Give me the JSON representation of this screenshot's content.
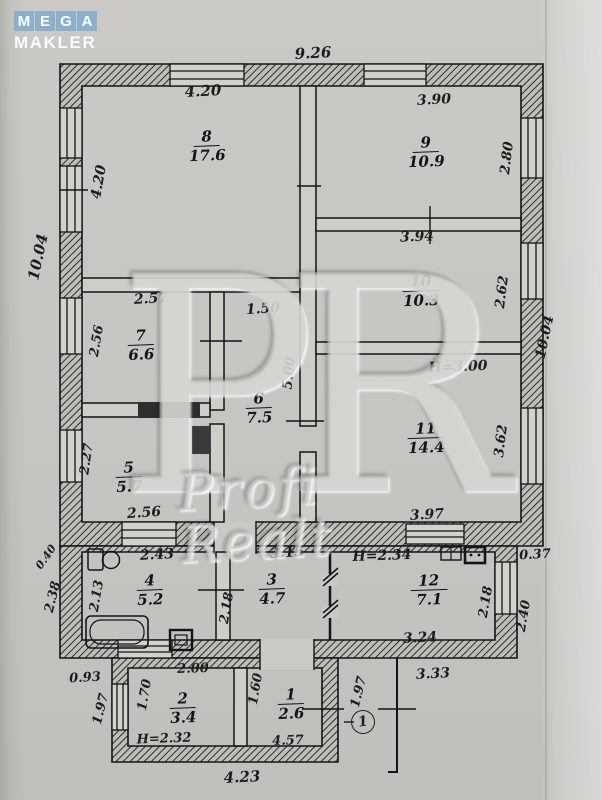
{
  "logo": {
    "letters": [
      "M",
      "E",
      "G",
      "A"
    ],
    "word": "MAKLER"
  },
  "watermark": {
    "monogram": "PR",
    "text": "Profi Realt"
  },
  "plan": {
    "porch_label": "1",
    "rooms": [
      {
        "number": "8",
        "area": "17.6",
        "x": 207,
        "y": 146
      },
      {
        "number": "9",
        "area": "10.9",
        "x": 426,
        "y": 152
      },
      {
        "number": "10",
        "area": "10.3",
        "x": 421,
        "y": 291
      },
      {
        "number": "11",
        "area": "14.4",
        "x": 426,
        "y": 438
      },
      {
        "number": "7",
        "area": "6.6",
        "x": 141,
        "y": 345
      },
      {
        "number": "6",
        "area": "7.5",
        "x": 259,
        "y": 408
      },
      {
        "number": "5",
        "area": "5.7",
        "x": 129,
        "y": 477
      },
      {
        "number": "4",
        "area": "5.2",
        "x": 150,
        "y": 590
      },
      {
        "number": "3",
        "area": "4.7",
        "x": 272,
        "y": 589
      },
      {
        "number": "12",
        "area": "7.1",
        "x": 429,
        "y": 590
      },
      {
        "number": "2",
        "area": "3.4",
        "x": 183,
        "y": 708
      },
      {
        "number": "1",
        "area": "2.6",
        "x": 291,
        "y": 704
      }
    ],
    "dims": [
      {
        "text": "9.26",
        "x": 313,
        "y": 53,
        "rot": -3,
        "size": 15
      },
      {
        "text": "4.20",
        "x": 203,
        "y": 91,
        "rot": -3,
        "size": 15
      },
      {
        "text": "4.20",
        "x": 99,
        "y": 182,
        "rot": -80,
        "size": 14
      },
      {
        "text": "10.04",
        "x": 38,
        "y": 257,
        "rot": -78,
        "size": 15
      },
      {
        "text": "3.90",
        "x": 434,
        "y": 100,
        "rot": -3,
        "size": 14
      },
      {
        "text": "2.80",
        "x": 507,
        "y": 158,
        "rot": -83,
        "size": 13.5
      },
      {
        "text": "3.94",
        "x": 417,
        "y": 237,
        "rot": -2,
        "size": 14
      },
      {
        "text": "2.62",
        "x": 502,
        "y": 292,
        "rot": -83,
        "size": 13.5
      },
      {
        "text": "10.04",
        "x": 545,
        "y": 337,
        "rot": -78,
        "size": 14
      },
      {
        "text": "H=3.00",
        "x": 458,
        "y": 367,
        "rot": -2,
        "size": 14
      },
      {
        "text": "3.62",
        "x": 501,
        "y": 441,
        "rot": -83,
        "size": 13.5
      },
      {
        "text": "3.97",
        "x": 427,
        "y": 515,
        "rot": -3,
        "size": 14
      },
      {
        "text": "2.57",
        "x": 151,
        "y": 299,
        "rot": -3,
        "size": 14
      },
      {
        "text": "2.56",
        "x": 97,
        "y": 341,
        "rot": -80,
        "size": 13
      },
      {
        "text": "1.50",
        "x": 263,
        "y": 309,
        "rot": -4,
        "size": 14
      },
      {
        "text": "5.00",
        "x": 289,
        "y": 373,
        "rot": -85,
        "size": 13.5
      },
      {
        "text": "2.27",
        "x": 87,
        "y": 459,
        "rot": -82,
        "size": 13
      },
      {
        "text": "2.56",
        "x": 144,
        "y": 513,
        "rot": -4,
        "size": 14
      },
      {
        "text": "0.40",
        "x": 46,
        "y": 557,
        "rot": -55,
        "size": 11
      },
      {
        "text": "2.38",
        "x": 53,
        "y": 597,
        "rot": -76,
        "size": 13
      },
      {
        "text": "2.43",
        "x": 157,
        "y": 555,
        "rot": -3,
        "size": 14
      },
      {
        "text": "2.13",
        "x": 97,
        "y": 596,
        "rot": -80,
        "size": 13
      },
      {
        "text": "3.15",
        "x": 287,
        "y": 553,
        "rot": -4,
        "size": 14
      },
      {
        "text": "2.18",
        "x": 227,
        "y": 608,
        "rot": -80,
        "size": 13
      },
      {
        "text": "H=2.34",
        "x": 382,
        "y": 556,
        "rot": -2,
        "size": 14
      },
      {
        "text": "2.18",
        "x": 486,
        "y": 602,
        "rot": -80,
        "size": 13
      },
      {
        "text": "0.37",
        "x": 535,
        "y": 555,
        "rot": -3,
        "size": 13
      },
      {
        "text": "2.40",
        "x": 524,
        "y": 616,
        "rot": -80,
        "size": 13
      },
      {
        "text": "3.24",
        "x": 420,
        "y": 638,
        "rot": -3,
        "size": 14
      },
      {
        "text": "3.33",
        "x": 433,
        "y": 674,
        "rot": -3,
        "size": 14
      },
      {
        "text": "0.93",
        "x": 85,
        "y": 678,
        "rot": -3,
        "size": 13
      },
      {
        "text": "2.00",
        "x": 193,
        "y": 669,
        "rot": -2,
        "size": 13
      },
      {
        "text": "1.70",
        "x": 145,
        "y": 695,
        "rot": -80,
        "size": 13
      },
      {
        "text": "1.60",
        "x": 256,
        "y": 689,
        "rot": -80,
        "size": 13
      },
      {
        "text": "1.97",
        "x": 101,
        "y": 709,
        "rot": -76,
        "size": 13
      },
      {
        "text": "1.97",
        "x": 359,
        "y": 692,
        "rot": -76,
        "size": 13
      },
      {
        "text": "H=2.32",
        "x": 164,
        "y": 739,
        "rot": -2,
        "size": 13
      },
      {
        "text": "4.57",
        "x": 288,
        "y": 741,
        "rot": -2,
        "size": 13
      },
      {
        "text": "4.23",
        "x": 242,
        "y": 777,
        "rot": -3,
        "size": 15
      }
    ]
  }
}
